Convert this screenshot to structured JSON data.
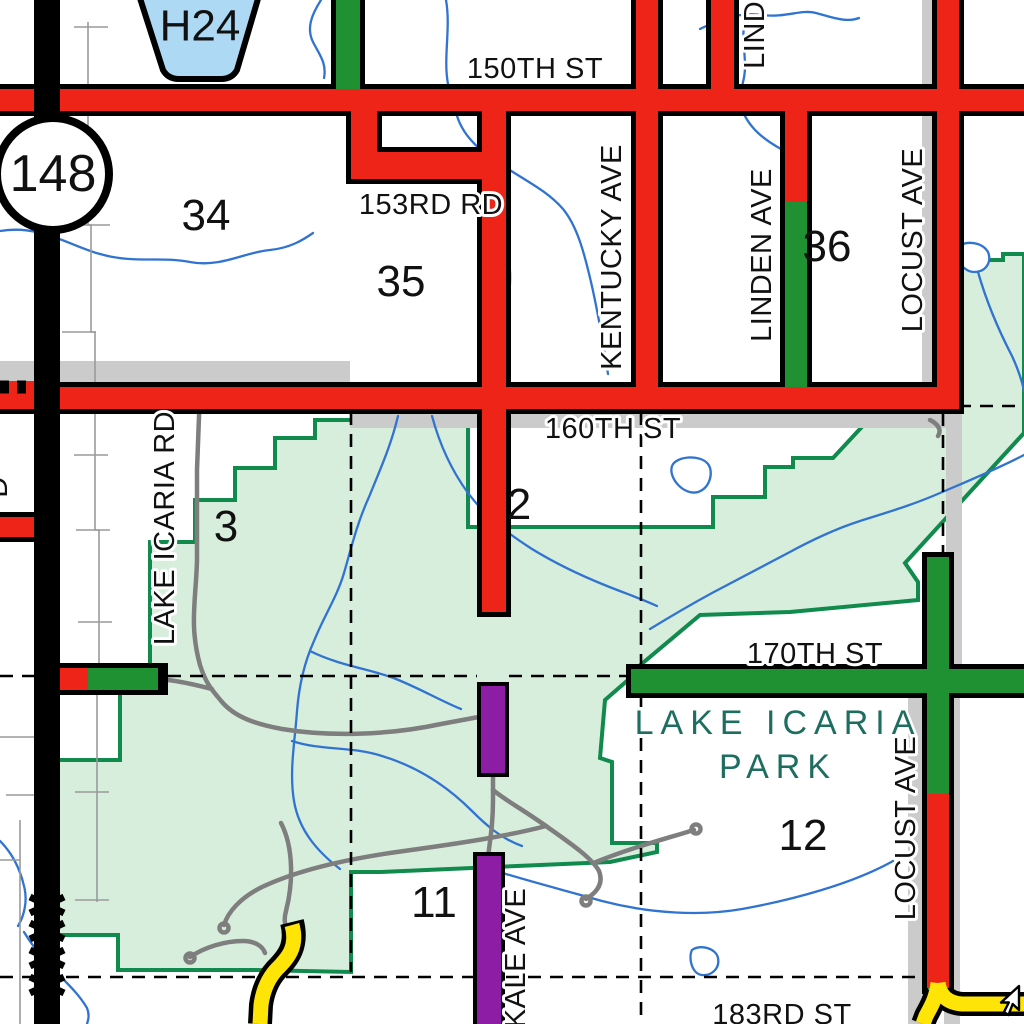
{
  "map": {
    "title": "Lake Icaria Park road map",
    "road_labels": {
      "st150": "150TH ST",
      "rd153": "153RD RD",
      "st160": "160TH ST",
      "st170": "170TH ST",
      "st183": "183RD ST",
      "kentucky": "KENTUCKY AVE",
      "linden": "LINDEN AVE",
      "linden_top": "LINDEN AVE",
      "locust_top": "LOCUST AVE",
      "locust_bottom": "LOCUST AVE",
      "icaria_rd": "LAKE ICARIA RD",
      "kale": "KALE AVE",
      "edge_letter": "D"
    },
    "section_numbers": {
      "s34": "34",
      "s35": "35",
      "s36": "36",
      "s2": "2",
      "s3": "3",
      "s11": "11",
      "s12": "12"
    },
    "park": {
      "line1": "LAKE ICARIA",
      "line2": "PARK"
    },
    "shields": {
      "state_route": "148",
      "county_route": "H24"
    },
    "colors": {
      "road_red": "#ee2418",
      "road_green": "#1f9132",
      "road_yellow": "#ffe408",
      "road_purple": "#8d1da4",
      "road_black": "#000000",
      "park_fill": "#d8eedd",
      "park_border": "#108a4d",
      "water_blue": "#3173d1",
      "band_gray": "#cbcbcb",
      "trail_gray": "#7e7e7e",
      "shield_blue": "#aed9f5",
      "park_text": "#1e6e60"
    }
  }
}
